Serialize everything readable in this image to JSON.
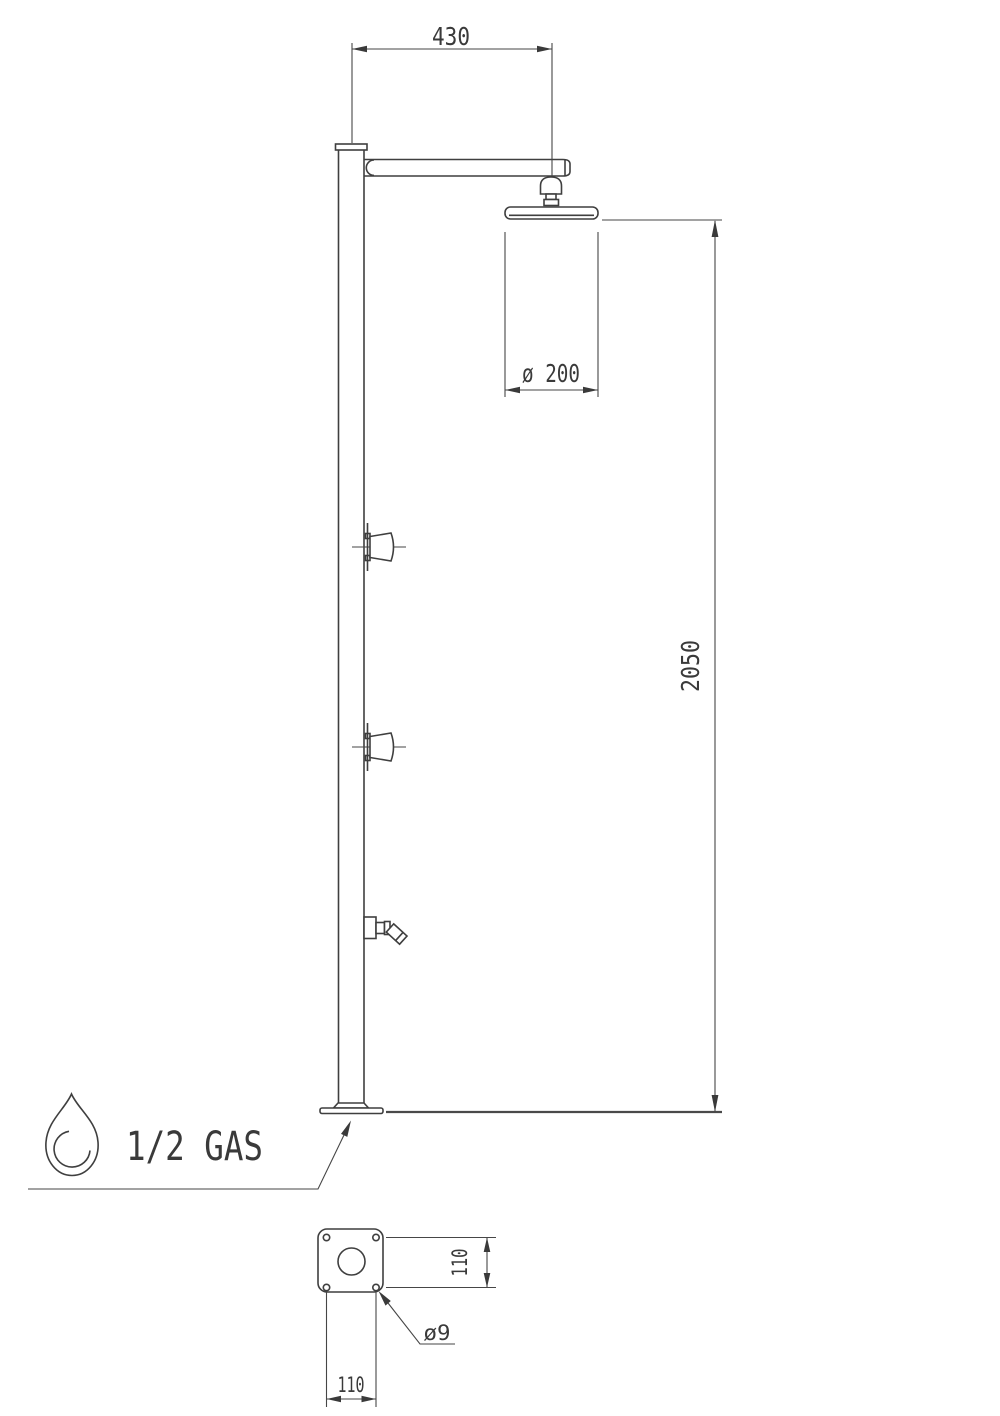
{
  "drawing": {
    "dims": {
      "arm_length": "430",
      "head_diameter": "ø 200",
      "total_height": "2050",
      "bolt_spacing_vertical": "110",
      "bolt_spacing_horizontal": "110",
      "bolt_hole_diameter": "ø9",
      "water_connection": "1/2 GAS"
    },
    "colors": {
      "line": "#3f3f3f",
      "text": "#3a3a3a",
      "background": "#ffffff"
    }
  }
}
